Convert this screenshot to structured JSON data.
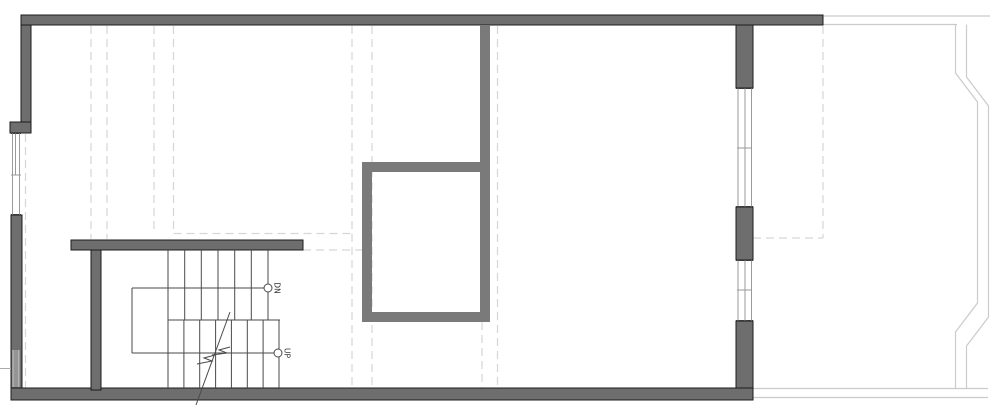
{
  "plan": {
    "labels": {
      "down": "DN",
      "up": "UP"
    },
    "colors": {
      "background": "#ffffff",
      "wall_fill": "#6e6e6e",
      "wall_outline": "#1c1c1c",
      "shaft_fill": "#7a7a7a",
      "line_dark": "#4a4a4a",
      "deck_line": "#cbcbcb",
      "dash_line": "#d6d6d6",
      "window_line": "#9a9a9a"
    }
  }
}
